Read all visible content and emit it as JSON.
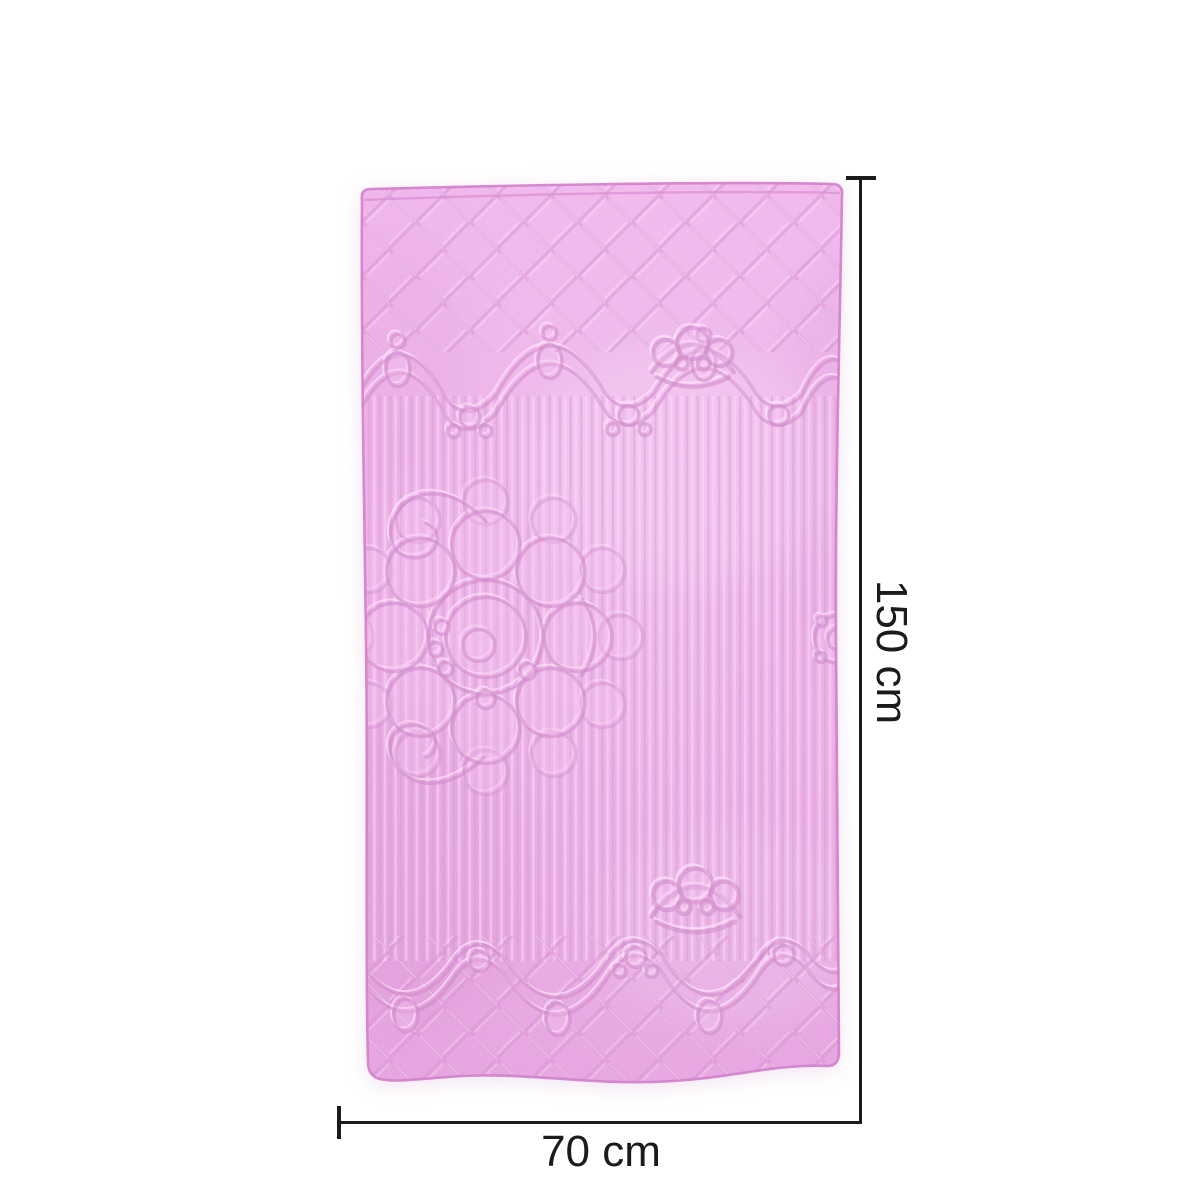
{
  "figure": {
    "type": "product-dimension-diagram",
    "background_color": "#ffffff"
  },
  "product": {
    "name": "Pink quilted embossed towel",
    "visual": "Quilted diamond-stitch borders top and bottom, scalloped garland bands with pearls and pendants, vertical ribbed centre, large floral medallion on left, crown motifs near top and bottom",
    "colors": {
      "base": "#e89ce2",
      "base-light": "#f4bced",
      "base-dark": "#dd8ed6",
      "stitch-shadow": "#c36dbb",
      "stitch-highlight": "#ffe0fa",
      "hem": "#d27fcb"
    }
  },
  "annotations": {
    "ink_color": "#1b1b1b",
    "height": {
      "label": "150 cm"
    },
    "width": {
      "label": "70 cm"
    }
  }
}
